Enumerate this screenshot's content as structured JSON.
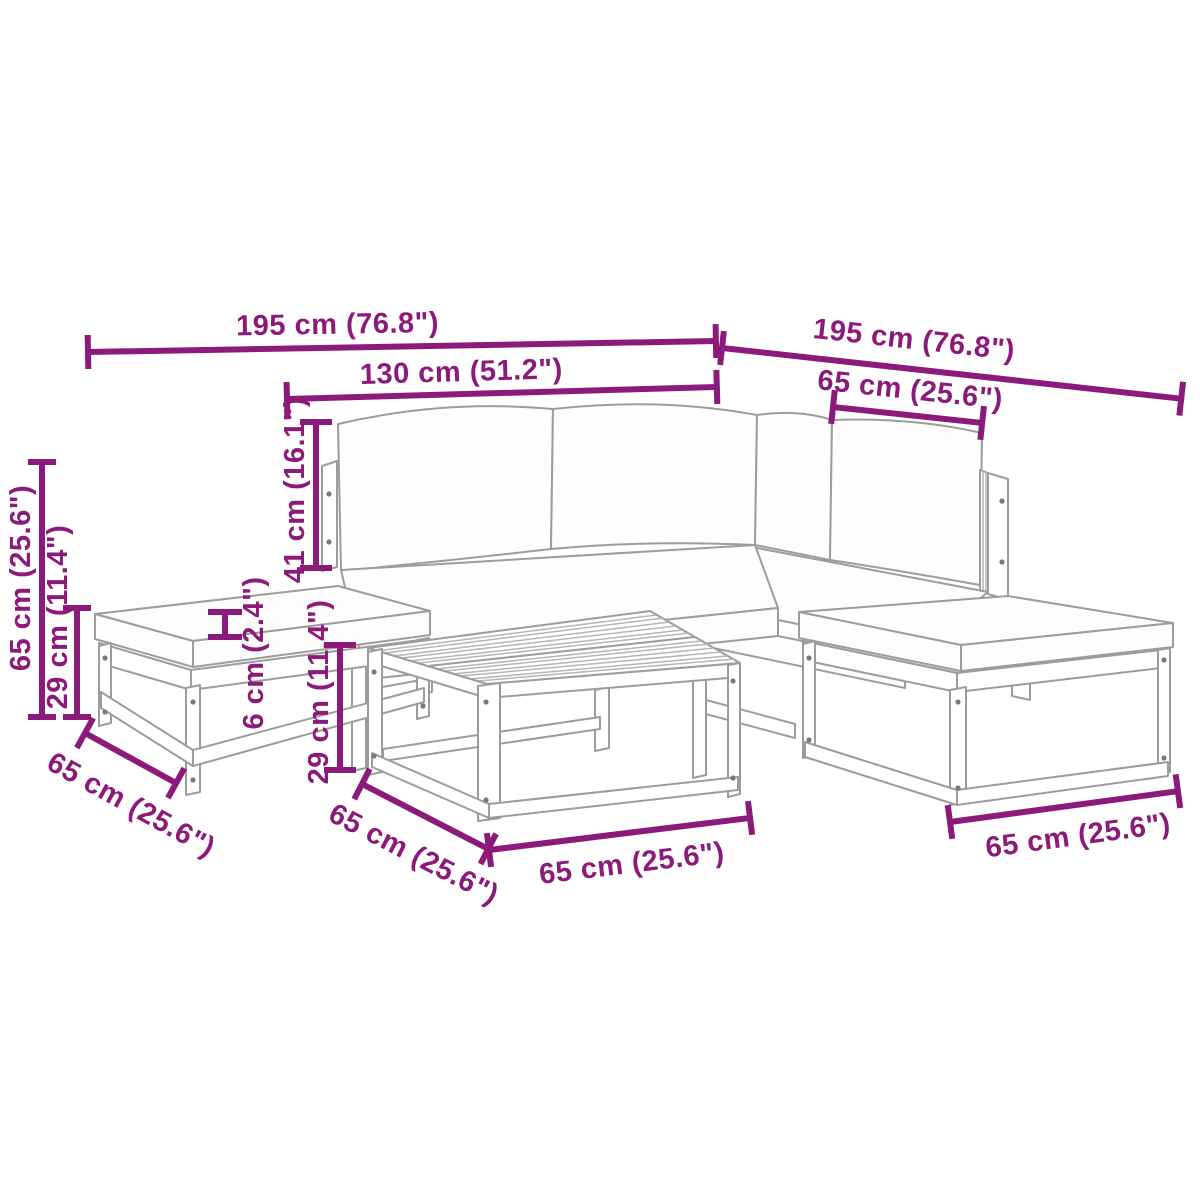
{
  "colors": {
    "dimension_annotation": "#8c1a7b",
    "furniture_outline": "#9c9c9c",
    "background": "#ffffff"
  },
  "diagram": {
    "description": "Garden lounge furniture set dimension drawing: corner sofa modules with cushions, two footstools and a slatted coffee table",
    "annotations": {
      "sofa_left_total_width": "195 cm (76.8\")",
      "sofa_back_inner_width": "130 cm (51.2\")",
      "sofa_right_total_width": "195 cm (76.8\")",
      "right_module_width": "65 cm (25.6\")",
      "total_height": "65 cm (25.6\")",
      "seat_height": "29 cm (11.4\")",
      "backrest_height": "41 cm (16.1\")",
      "cushion_thickness": "6 cm (2.4\")",
      "table_height": "29 cm (11.4\")",
      "left_footstool_depth": "65 cm (25.6\")",
      "table_depth": "65 cm (25.6\")",
      "table_width": "65 cm (25.6\")",
      "right_footstool_width": "65 cm (25.6\")"
    }
  }
}
